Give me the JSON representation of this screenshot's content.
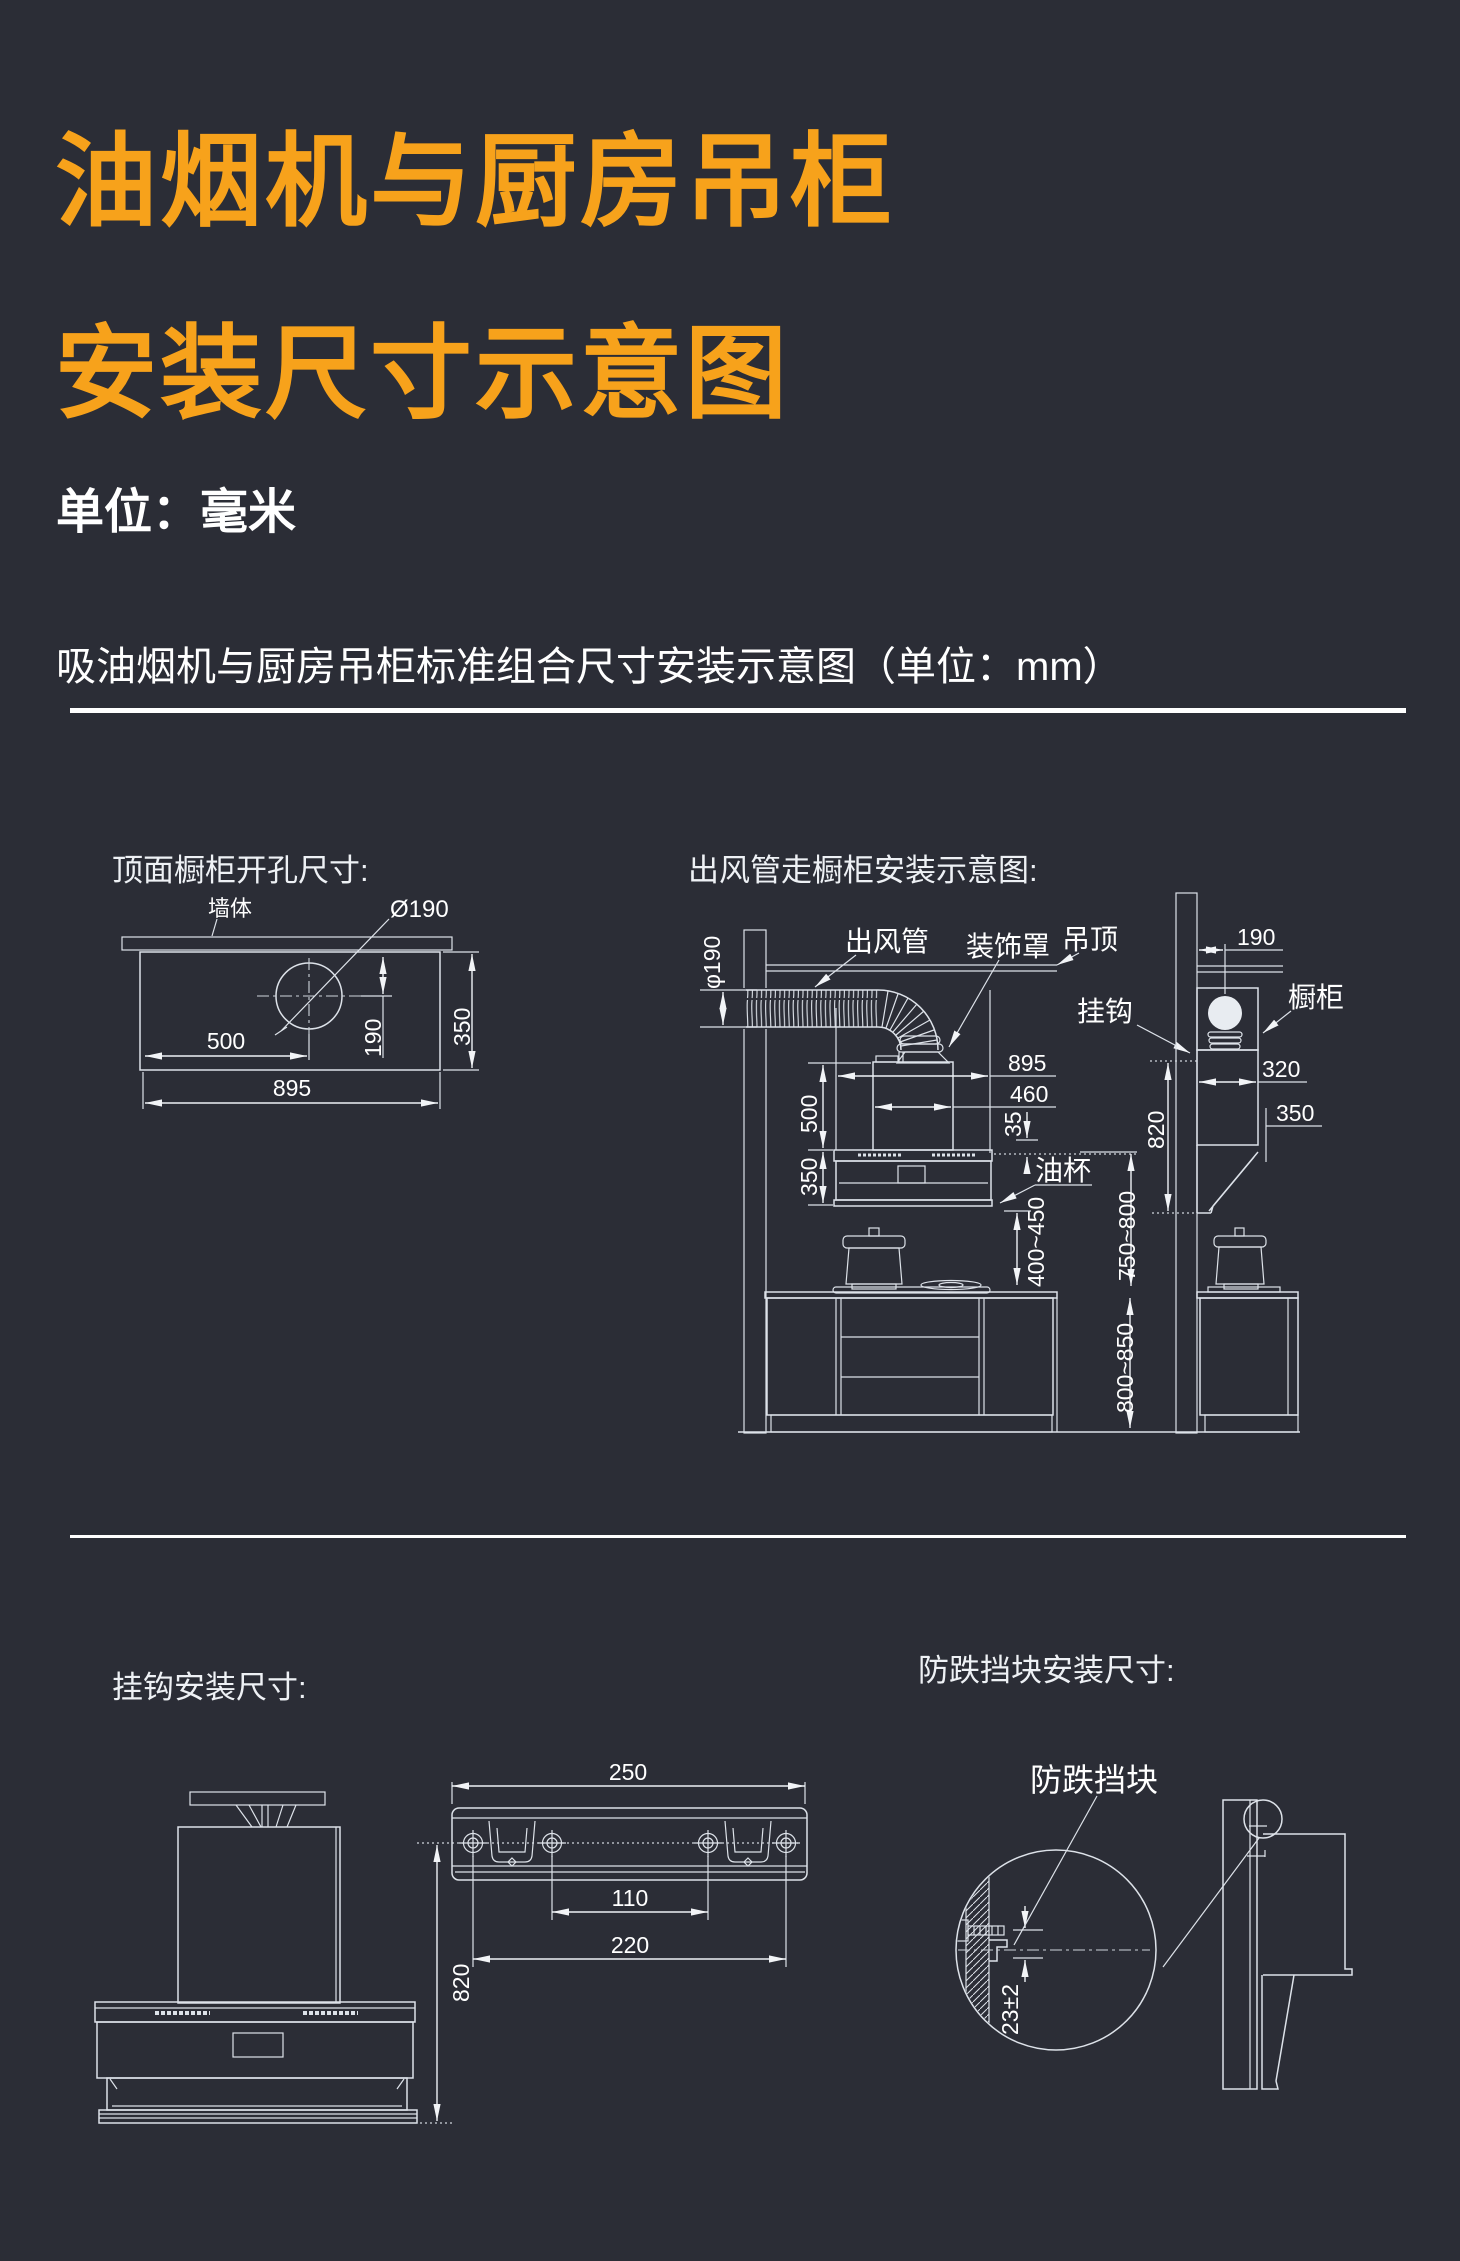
{
  "page": {
    "background": "#2b2d36",
    "accent_color": "#f7a21b",
    "line_color": "#ffffff"
  },
  "header": {
    "title_line1": "油烟机与厨房吊柜",
    "title_line2": "安装尺寸示意图",
    "unit_note": "单位：毫米",
    "combo_heading": "吸油烟机与厨房吊柜标准组合尺寸安装示意图（单位：mm）"
  },
  "top_hole_diagram": {
    "title": "顶面橱柜开孔尺寸:",
    "wall_label": "墙体",
    "hole_label": "Ø190",
    "dim_500": "500",
    "dim_895": "895",
    "dim_190": "190",
    "dim_350": "350"
  },
  "duct_diagram": {
    "title": "出风管走橱柜安装示意图:",
    "duct_label": "出风管",
    "cover_label": "装饰罩",
    "ceiling_label": "吊顶",
    "hook_label": "挂钩",
    "cabinet_label": "橱柜",
    "oilcup_label": "油杯",
    "dim_phi190": "φ190",
    "dim_895": "895",
    "dim_460": "460",
    "dim_35": "35",
    "dim_500": "500",
    "dim_350_front": "350",
    "dim_190": "190",
    "dim_320": "320",
    "dim_350_side": "350",
    "dim_820": "820",
    "dim_400_450": "400~450",
    "dim_750_800": "750~800",
    "dim_800_850": "800~850"
  },
  "hook_diagram": {
    "title": "挂钩安装尺寸:",
    "dim_250": "250",
    "dim_110": "110",
    "dim_220": "220",
    "dim_820": "820"
  },
  "block_diagram": {
    "title": "防跌挡块安装尺寸:",
    "block_label": "防跌挡块",
    "dim_23": "23±2"
  }
}
